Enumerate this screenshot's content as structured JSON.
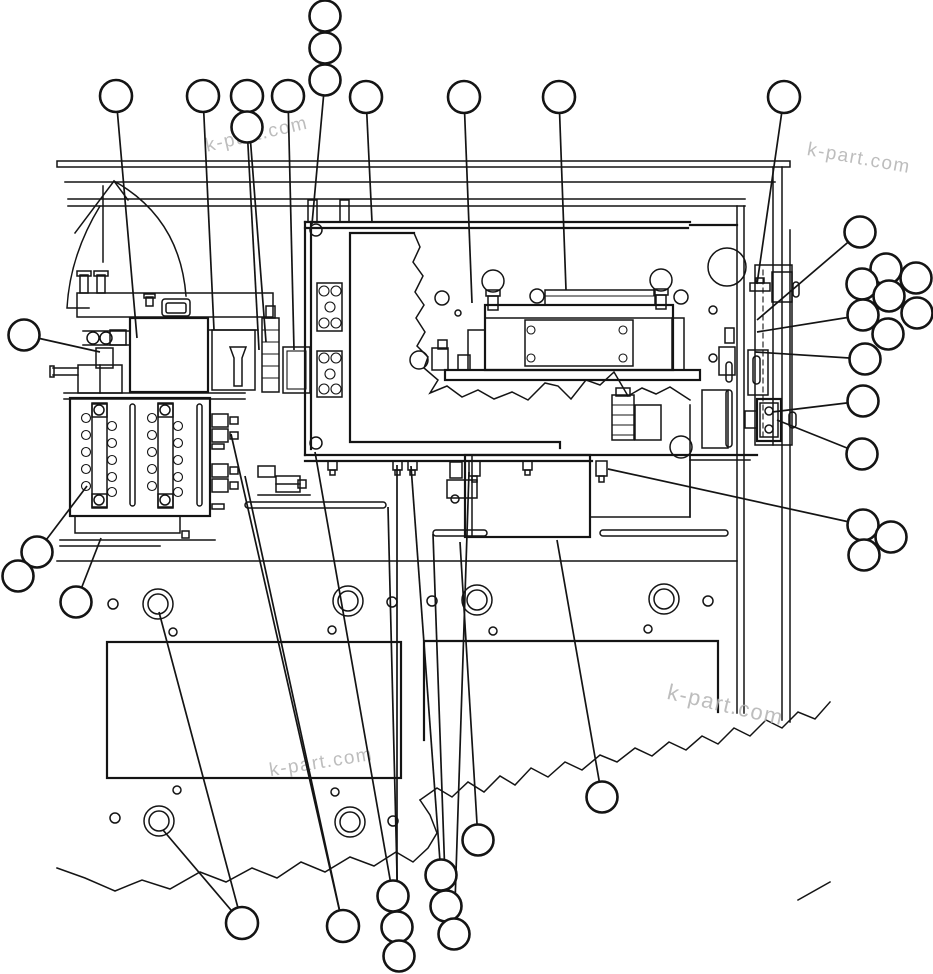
{
  "diagram": {
    "type": "parts-assembly-line-drawing",
    "canvas": {
      "width": 933,
      "height": 974,
      "background": "#ffffff",
      "line_color": "#141414"
    },
    "watermark_text": "k-part.com",
    "watermarks": [
      {
        "text": "k-part.com",
        "x": 258,
        "y": 140,
        "rotate": -13,
        "size": 19
      },
      {
        "text": "k-part.com",
        "x": 858,
        "y": 164,
        "rotate": 10,
        "size": 19
      },
      {
        "text": "k-part.com",
        "x": 724,
        "y": 712,
        "rotate": 13,
        "size": 22
      },
      {
        "text": "k-part.com",
        "x": 322,
        "y": 768,
        "rotate": -9,
        "size": 19
      }
    ],
    "balloon_style": {
      "stroke": "#141414",
      "stroke_width": 2.6,
      "fill": "#ffffff",
      "label": ""
    },
    "leader_style": {
      "stroke": "#141414",
      "stroke_width": 1.7
    },
    "callouts": [
      {
        "id": 1,
        "label": "",
        "cx": 325,
        "cy": 16,
        "r": 15.5,
        "leaders": []
      },
      {
        "id": 2,
        "label": "",
        "cx": 325,
        "cy": 48,
        "r": 15.5,
        "leaders": []
      },
      {
        "id": 3,
        "label": "",
        "cx": 325,
        "cy": 80,
        "r": 15.5,
        "leaders": [
          [
            312,
            224
          ]
        ]
      },
      {
        "id": 4,
        "label": "",
        "cx": 116,
        "cy": 96,
        "r": 16,
        "leaders": [
          [
            137,
            338
          ]
        ]
      },
      {
        "id": 5,
        "label": "",
        "cx": 203,
        "cy": 96,
        "r": 16,
        "leaders": [
          [
            214,
            330
          ]
        ]
      },
      {
        "id": 6,
        "label": "",
        "cx": 247,
        "cy": 96,
        "r": 16,
        "leaders": [
          [
            266,
            342
          ]
        ]
      },
      {
        "id": 7,
        "label": "",
        "cx": 247,
        "cy": 127,
        "r": 15.5,
        "leaders": [
          [
            259,
            350
          ]
        ]
      },
      {
        "id": 8,
        "label": "",
        "cx": 288,
        "cy": 96,
        "r": 16,
        "leaders": [
          [
            294,
            350
          ]
        ]
      },
      {
        "id": 9,
        "label": "",
        "cx": 366,
        "cy": 97,
        "r": 16,
        "leaders": [
          [
            372,
            222
          ]
        ]
      },
      {
        "id": 10,
        "label": "",
        "cx": 464,
        "cy": 97,
        "r": 16,
        "leaders": [
          [
            472,
            303
          ]
        ]
      },
      {
        "id": 11,
        "label": "",
        "cx": 559,
        "cy": 97,
        "r": 16,
        "leaders": [
          [
            566,
            290
          ]
        ]
      },
      {
        "id": 12,
        "label": "",
        "cx": 784,
        "cy": 97,
        "r": 16,
        "leaders": [
          [
            757,
            284
          ]
        ]
      },
      {
        "id": 13,
        "label": "",
        "cx": 24,
        "cy": 335,
        "r": 15.5,
        "leaders": [
          [
            100,
            352
          ]
        ]
      },
      {
        "id": 14,
        "label": "",
        "cx": 860,
        "cy": 232,
        "r": 15.5,
        "leaders": [
          [
            757,
            320
          ]
        ]
      },
      {
        "id": 15,
        "label": "",
        "cx": 886,
        "cy": 269,
        "r": 15.5,
        "leaders": []
      },
      {
        "id": 16,
        "label": "",
        "cx": 916,
        "cy": 278,
        "r": 15.5,
        "leaders": []
      },
      {
        "id": 17,
        "label": "",
        "cx": 862,
        "cy": 284,
        "r": 15.5,
        "leaders": []
      },
      {
        "id": 18,
        "label": "",
        "cx": 889,
        "cy": 296,
        "r": 15.5,
        "leaders": []
      },
      {
        "id": 19,
        "label": "",
        "cx": 917,
        "cy": 313,
        "r": 15.5,
        "leaders": []
      },
      {
        "id": 20,
        "label": "",
        "cx": 863,
        "cy": 315,
        "r": 15.5,
        "leaders": [
          [
            757,
            332
          ]
        ]
      },
      {
        "id": 21,
        "label": "",
        "cx": 888,
        "cy": 334,
        "r": 15.5,
        "leaders": []
      },
      {
        "id": 22,
        "label": "",
        "cx": 865,
        "cy": 359,
        "r": 15.5,
        "leaders": [
          [
            755,
            352
          ]
        ]
      },
      {
        "id": 23,
        "label": "",
        "cx": 863,
        "cy": 401,
        "r": 15.5,
        "leaders": [
          [
            772,
            412
          ]
        ]
      },
      {
        "id": 24,
        "label": "",
        "cx": 862,
        "cy": 454,
        "r": 15.5,
        "leaders": [
          [
            777,
            420
          ]
        ]
      },
      {
        "id": 25,
        "label": "",
        "cx": 863,
        "cy": 525,
        "r": 15.5,
        "leaders": [
          [
            608,
            469
          ]
        ]
      },
      {
        "id": 26,
        "label": "",
        "cx": 891,
        "cy": 537,
        "r": 15.5,
        "leaders": []
      },
      {
        "id": 27,
        "label": "",
        "cx": 864,
        "cy": 555,
        "r": 15.5,
        "leaders": []
      },
      {
        "id": 28,
        "label": "",
        "cx": 37,
        "cy": 552,
        "r": 15.5,
        "leaders": [
          [
            87,
            486
          ]
        ]
      },
      {
        "id": 29,
        "label": "",
        "cx": 18,
        "cy": 576,
        "r": 15.5,
        "leaders": []
      },
      {
        "id": 30,
        "label": "",
        "cx": 76,
        "cy": 602,
        "r": 15.5,
        "leaders": [
          [
            101,
            538
          ]
        ]
      },
      {
        "id": 31,
        "label": "",
        "cx": 242,
        "cy": 923,
        "r": 16,
        "leaders": [
          [
            159,
            612
          ],
          [
            163,
            830
          ]
        ]
      },
      {
        "id": 32,
        "label": "",
        "cx": 343,
        "cy": 926,
        "r": 16,
        "leaders": [
          [
            231,
            434
          ],
          [
            245,
            476
          ]
        ]
      },
      {
        "id": 33,
        "label": "",
        "cx": 393,
        "cy": 896,
        "r": 15.5,
        "leaders": [
          [
            315,
            452
          ]
        ]
      },
      {
        "id": 34,
        "label": "",
        "cx": 397,
        "cy": 927,
        "r": 15.5,
        "leaders": [
          [
            397,
            465
          ]
        ]
      },
      {
        "id": 35,
        "label": "",
        "cx": 399,
        "cy": 956,
        "r": 15.5,
        "leaders": [
          [
            388,
            507
          ]
        ]
      },
      {
        "id": 36,
        "label": "",
        "cx": 441,
        "cy": 875,
        "r": 15.5,
        "leaders": [
          [
            411,
            466
          ]
        ]
      },
      {
        "id": 37,
        "label": "",
        "cx": 446,
        "cy": 906,
        "r": 15.5,
        "leaders": [
          [
            433,
            534
          ]
        ]
      },
      {
        "id": 38,
        "label": "",
        "cx": 454,
        "cy": 934,
        "r": 15.5,
        "leaders": [
          [
            469,
            472
          ]
        ]
      },
      {
        "id": 39,
        "label": "",
        "cx": 478,
        "cy": 840,
        "r": 15.5,
        "leaders": [
          [
            460,
            542
          ]
        ]
      },
      {
        "id": 40,
        "label": "",
        "cx": 602,
        "cy": 797,
        "r": 15.5,
        "leaders": [
          [
            557,
            540
          ]
        ]
      }
    ]
  }
}
